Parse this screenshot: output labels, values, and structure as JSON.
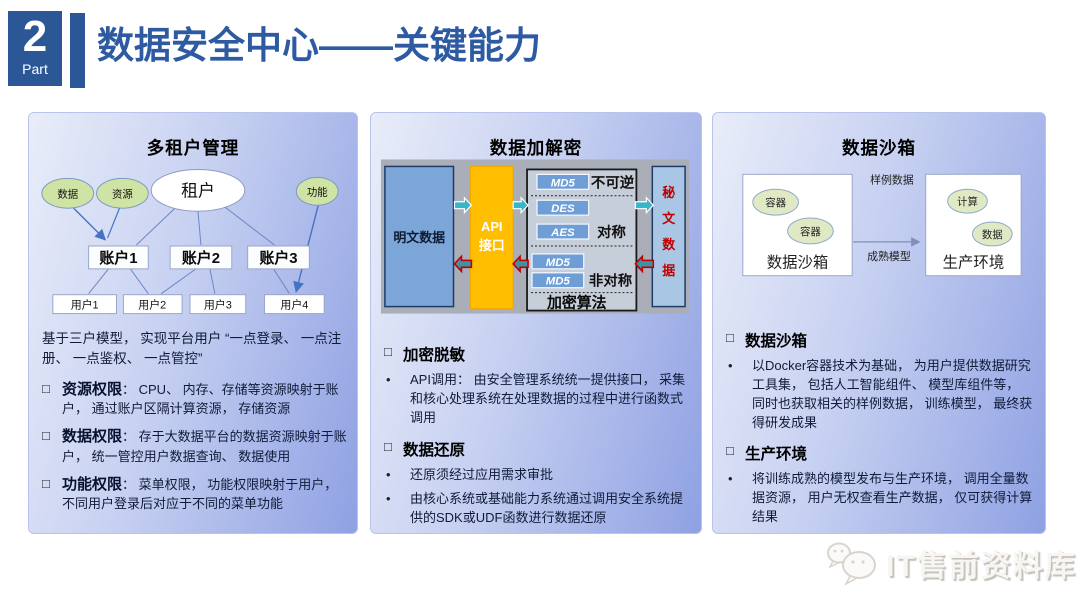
{
  "ui": {
    "checkbox": "□",
    "bullet": "•"
  },
  "header": {
    "part_number": "2",
    "part_label": "Part",
    "title": "数据安全中心——关键能力"
  },
  "panels": {
    "tenant": {
      "title": "多租户管理",
      "diagram": {
        "data_node": "数据",
        "resource_node": "资源",
        "tenant_node": "租户",
        "function_node": "功能",
        "accounts": [
          "账户1",
          "账户2",
          "账户3"
        ],
        "users": [
          "用户1",
          "用户2",
          "用户3",
          "用户4"
        ]
      },
      "intro": "基于三户模型， 实现平台用户 “一点登录、 一点注册、 一点鉴权、 一点管控”",
      "items": [
        {
          "term": "资源权限",
          "desc": "： CPU、 内存、存储等资源映射于账户， 通过账户区隔计算资源， 存储资源"
        },
        {
          "term": "数据权限",
          "desc": "： 存于大数据平台的数据资源映射于账户， 统一管控用户数据查询、 数据使用"
        },
        {
          "term": "功能权限",
          "desc": "： 菜单权限， 功能权限映射于用户， 不同用户登录后对应于不同的菜单功能"
        }
      ]
    },
    "encryption": {
      "title": "数据加解密",
      "diagram": {
        "plaintext": "明文数据",
        "api_line1": "API",
        "api_line2": "接口",
        "algos": [
          "MD5",
          "DES",
          "AES",
          "MD5",
          "MD5"
        ],
        "cat_irreversible": "不可逆",
        "cat_symmetric": "对称",
        "cat_asymmetric": "非对称",
        "box_label": "加密算法",
        "cipher_chars": [
          "秘",
          "文",
          "数",
          "据"
        ]
      },
      "sections": [
        {
          "heading": "加密脱敏",
          "bullets": [
            "API调用： 由安全管理系统统一提供接口， 采集和核心处理系统在处理数据的过程中进行函数式调用"
          ]
        },
        {
          "heading": "数据还原",
          "bullets": [
            "还原须经过应用需求审批",
            "由核心系统或基础能力系统通过调用安全系统提供的SDK或UDF函数进行数据还原"
          ]
        }
      ]
    },
    "sandbox": {
      "title": "数据沙箱",
      "diagram": {
        "left_label": "数据沙箱",
        "right_label": "生产环境",
        "containers": [
          "容器",
          "容器"
        ],
        "resources": [
          "计算",
          "数据"
        ],
        "top_label": "样例数据",
        "bottom_label": "成熟模型"
      },
      "sections": [
        {
          "heading": "数据沙箱",
          "bullets": [
            "以Docker容器技术为基础， 为用户提供数据研究工具集， 包括人工智能组件、 模型库组件等， 同时也获取相关的样例数据， 训练模型， 最终获得研发成果"
          ]
        },
        {
          "heading": "生产环境",
          "bullets": [
            "将训练成熟的模型发布与生产环境， 调用全量数据资源， 用户无权查看生产数据， 仅可获得计算结果"
          ]
        }
      ]
    }
  },
  "watermark": {
    "text": "IT售前资料库"
  },
  "colors": {
    "accent_blue": "#2e5aa2",
    "badge_blue": "#2b5797",
    "api_orange": "#ffbf00",
    "arrow_teal": "#38b5c8",
    "cipher_red": "#c00000",
    "node_green": "#cfe3a4"
  }
}
